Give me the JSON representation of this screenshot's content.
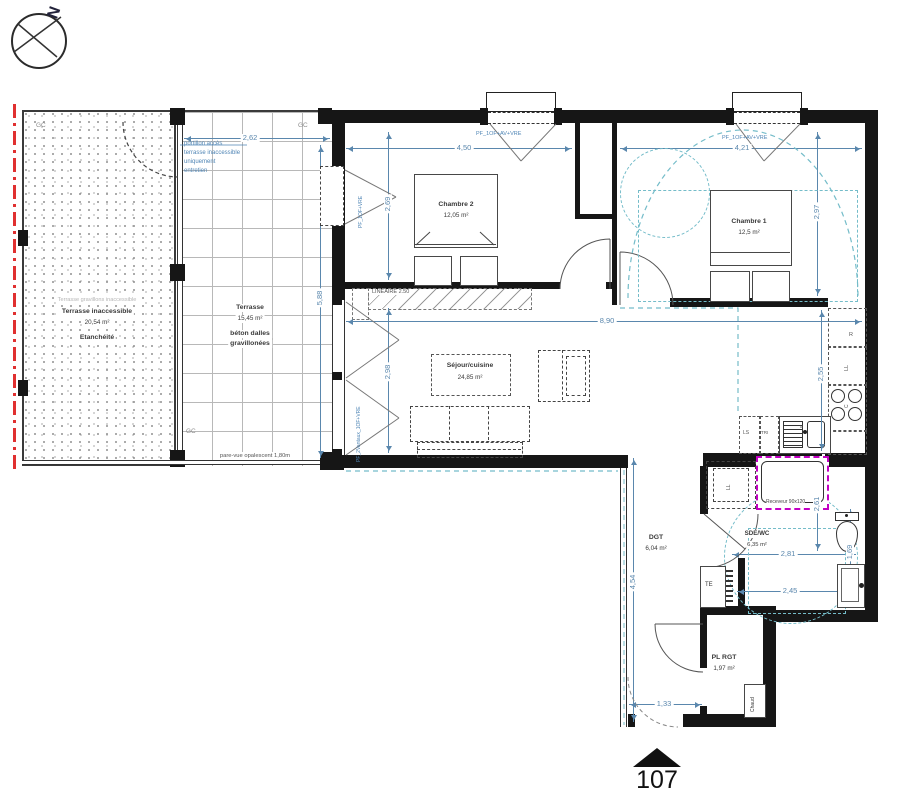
{
  "compass": {
    "north": "N"
  },
  "apartment": {
    "number": "107"
  },
  "rooms": {
    "terrasse_inaccessible": {
      "topnote": "Terrasse gravillons inaccessible",
      "name": "Terrasse inaccessible",
      "area": "20,54 m²",
      "note": "Etanchéité"
    },
    "terrasse": {
      "name": "Terrasse",
      "area": "15,45 m²",
      "note1": "béton dalles",
      "note2": "gravillonées"
    },
    "chambre2": {
      "name": "Chambre 2",
      "area": "12,05 m²"
    },
    "chambre1": {
      "name": "Chambre 1",
      "area": "12,5 m²"
    },
    "sejour": {
      "name": "Séjour/cuisine",
      "area": "24,85 m²"
    },
    "sde": {
      "name": "SDE/WC",
      "area": "6,35 m²"
    },
    "dgt": {
      "name": "DGT",
      "area": "6,04 m²"
    },
    "plrgt": {
      "name": "PL RGT",
      "area": "1,97 m²"
    }
  },
  "annotations": {
    "gc": "GC",
    "portillon": [
      "portillon accès",
      "terrasse inaccessible",
      "uniquement",
      "entretien"
    ],
    "pare_vue": "pare-vue opalescent 1,80m",
    "lineaire": "LINEAIRE 2.50",
    "window_top": "PF_1OF+AV+VRE",
    "window_ch2_left": "PF_1OF+VRE",
    "window_sejour": "PF_2Vantaux_1OF+VRE",
    "receveur": "Receveur 90x120",
    "te": "TE",
    "chaud": "Chaud",
    "ll_bath": "LL",
    "kitchen": {
      "r": "R",
      "ll": "LL",
      "c": "C",
      "ls": "LS",
      "tri": "TRI",
      "e": "E"
    }
  },
  "dimensions": {
    "terrasse_w": "2,62",
    "terrasse_h": "5,88",
    "ch2_w": "4,50",
    "ch2_h": "2,69",
    "ch1_w": "4,21",
    "ch1_h": "2,97",
    "sejour_w": "8,90",
    "sejour_h": "2,98",
    "kitchen_h": "2,55",
    "sdb_w1": "2,81",
    "sdb_w2": "2,45",
    "sdb_h1": "2,61",
    "sdb_h2": "1,69",
    "dgt_h": "4,54",
    "entry_w": "1,33"
  },
  "colors": {
    "wall": "#161616",
    "dimension_blue": "#5a87ad",
    "annotation_blue": "#4f85b5",
    "accessibility_teal": "#74bcc9",
    "shower_magenta": "#c300c3",
    "boundary_red": "#e03030"
  }
}
